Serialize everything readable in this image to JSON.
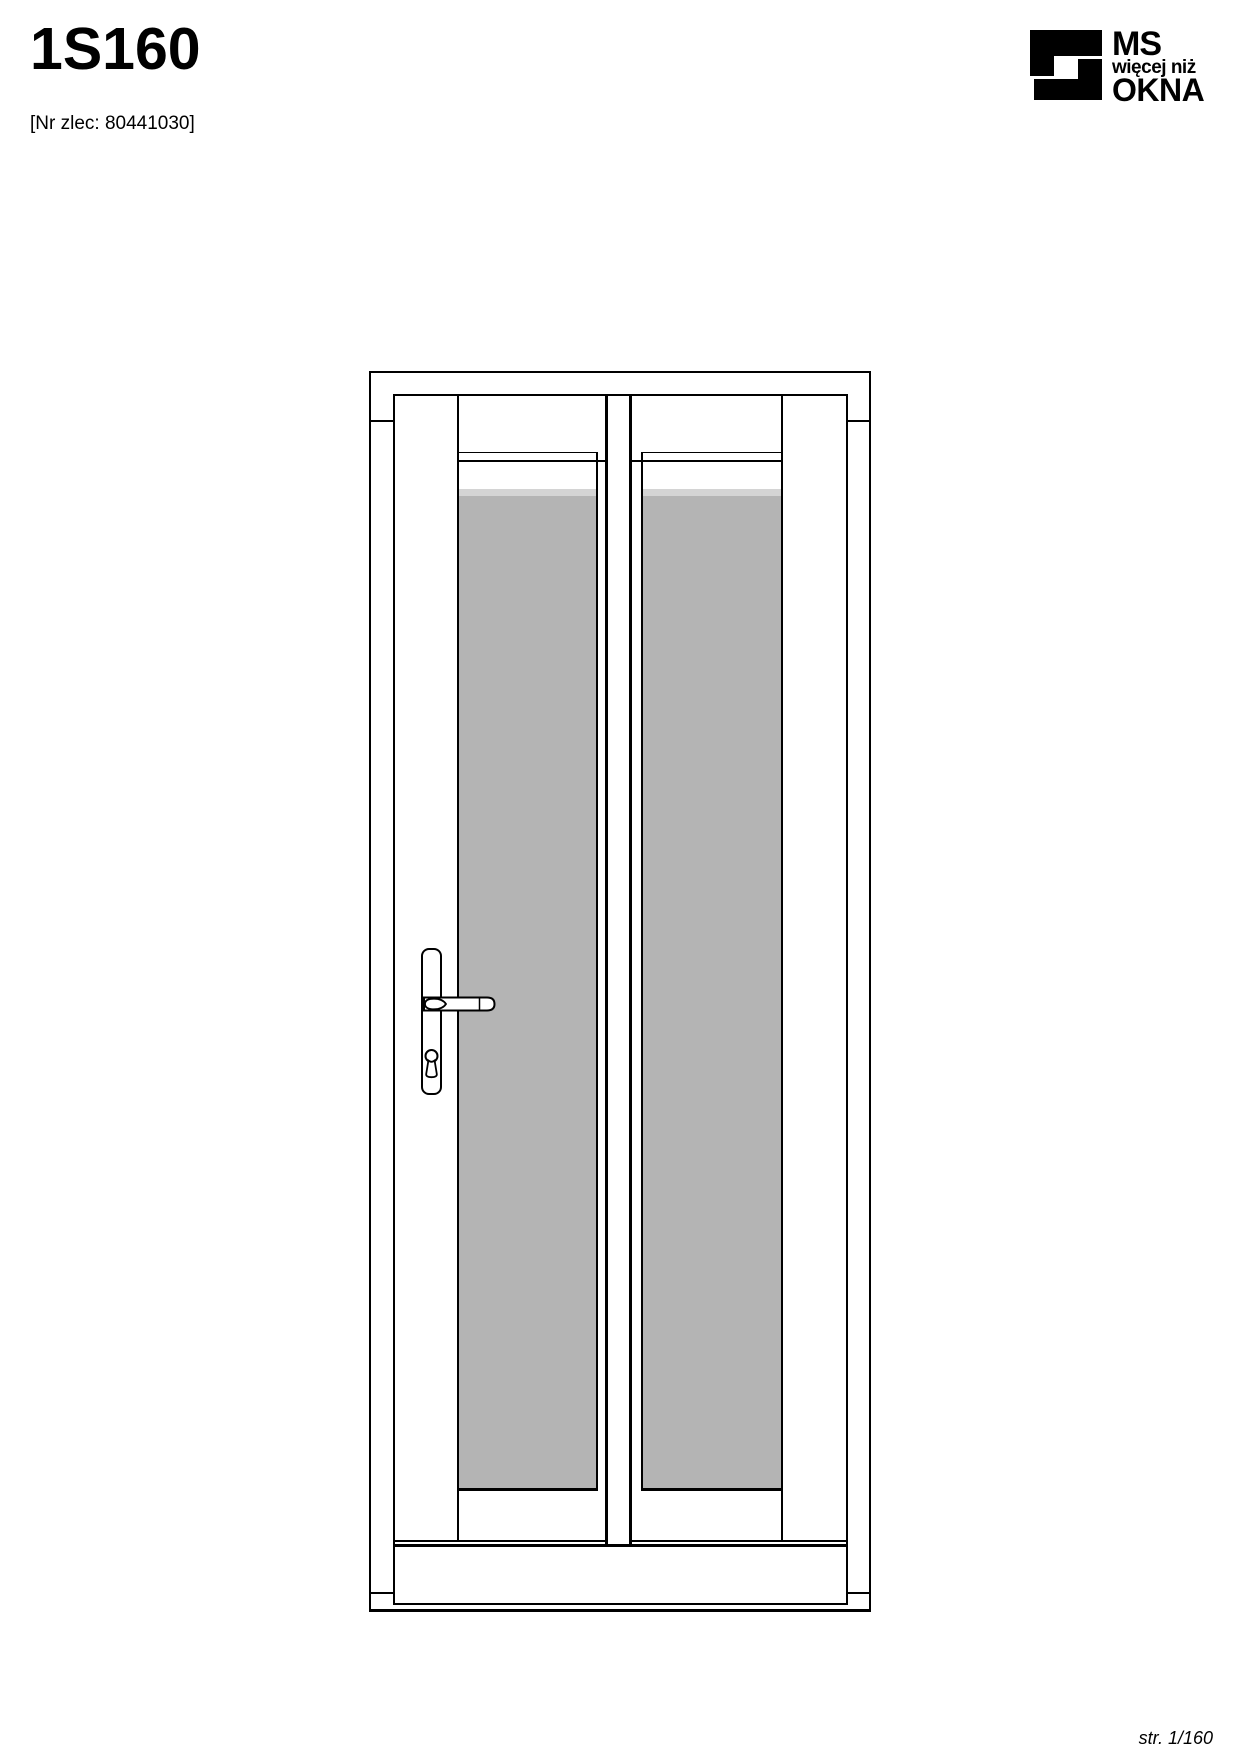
{
  "page": {
    "title": "1S160",
    "order_no": "[Nr zlec: 80441030]",
    "footer": "str. 1/160"
  },
  "logo": {
    "line1": "MS",
    "line2": "więcej niż",
    "line3": "OKNA",
    "color": "#000000"
  },
  "drawing": {
    "description": "front elevation of a single-leaf door, two vertical glass panes split by a central mullion, lever handle with key cylinder on left stile, threshold at bottom",
    "panes": 2,
    "handle_side": "left",
    "line_color": "#000000",
    "glass_color": "#b4b4b4",
    "glass_highlight_color": "#d4d4d4"
  }
}
